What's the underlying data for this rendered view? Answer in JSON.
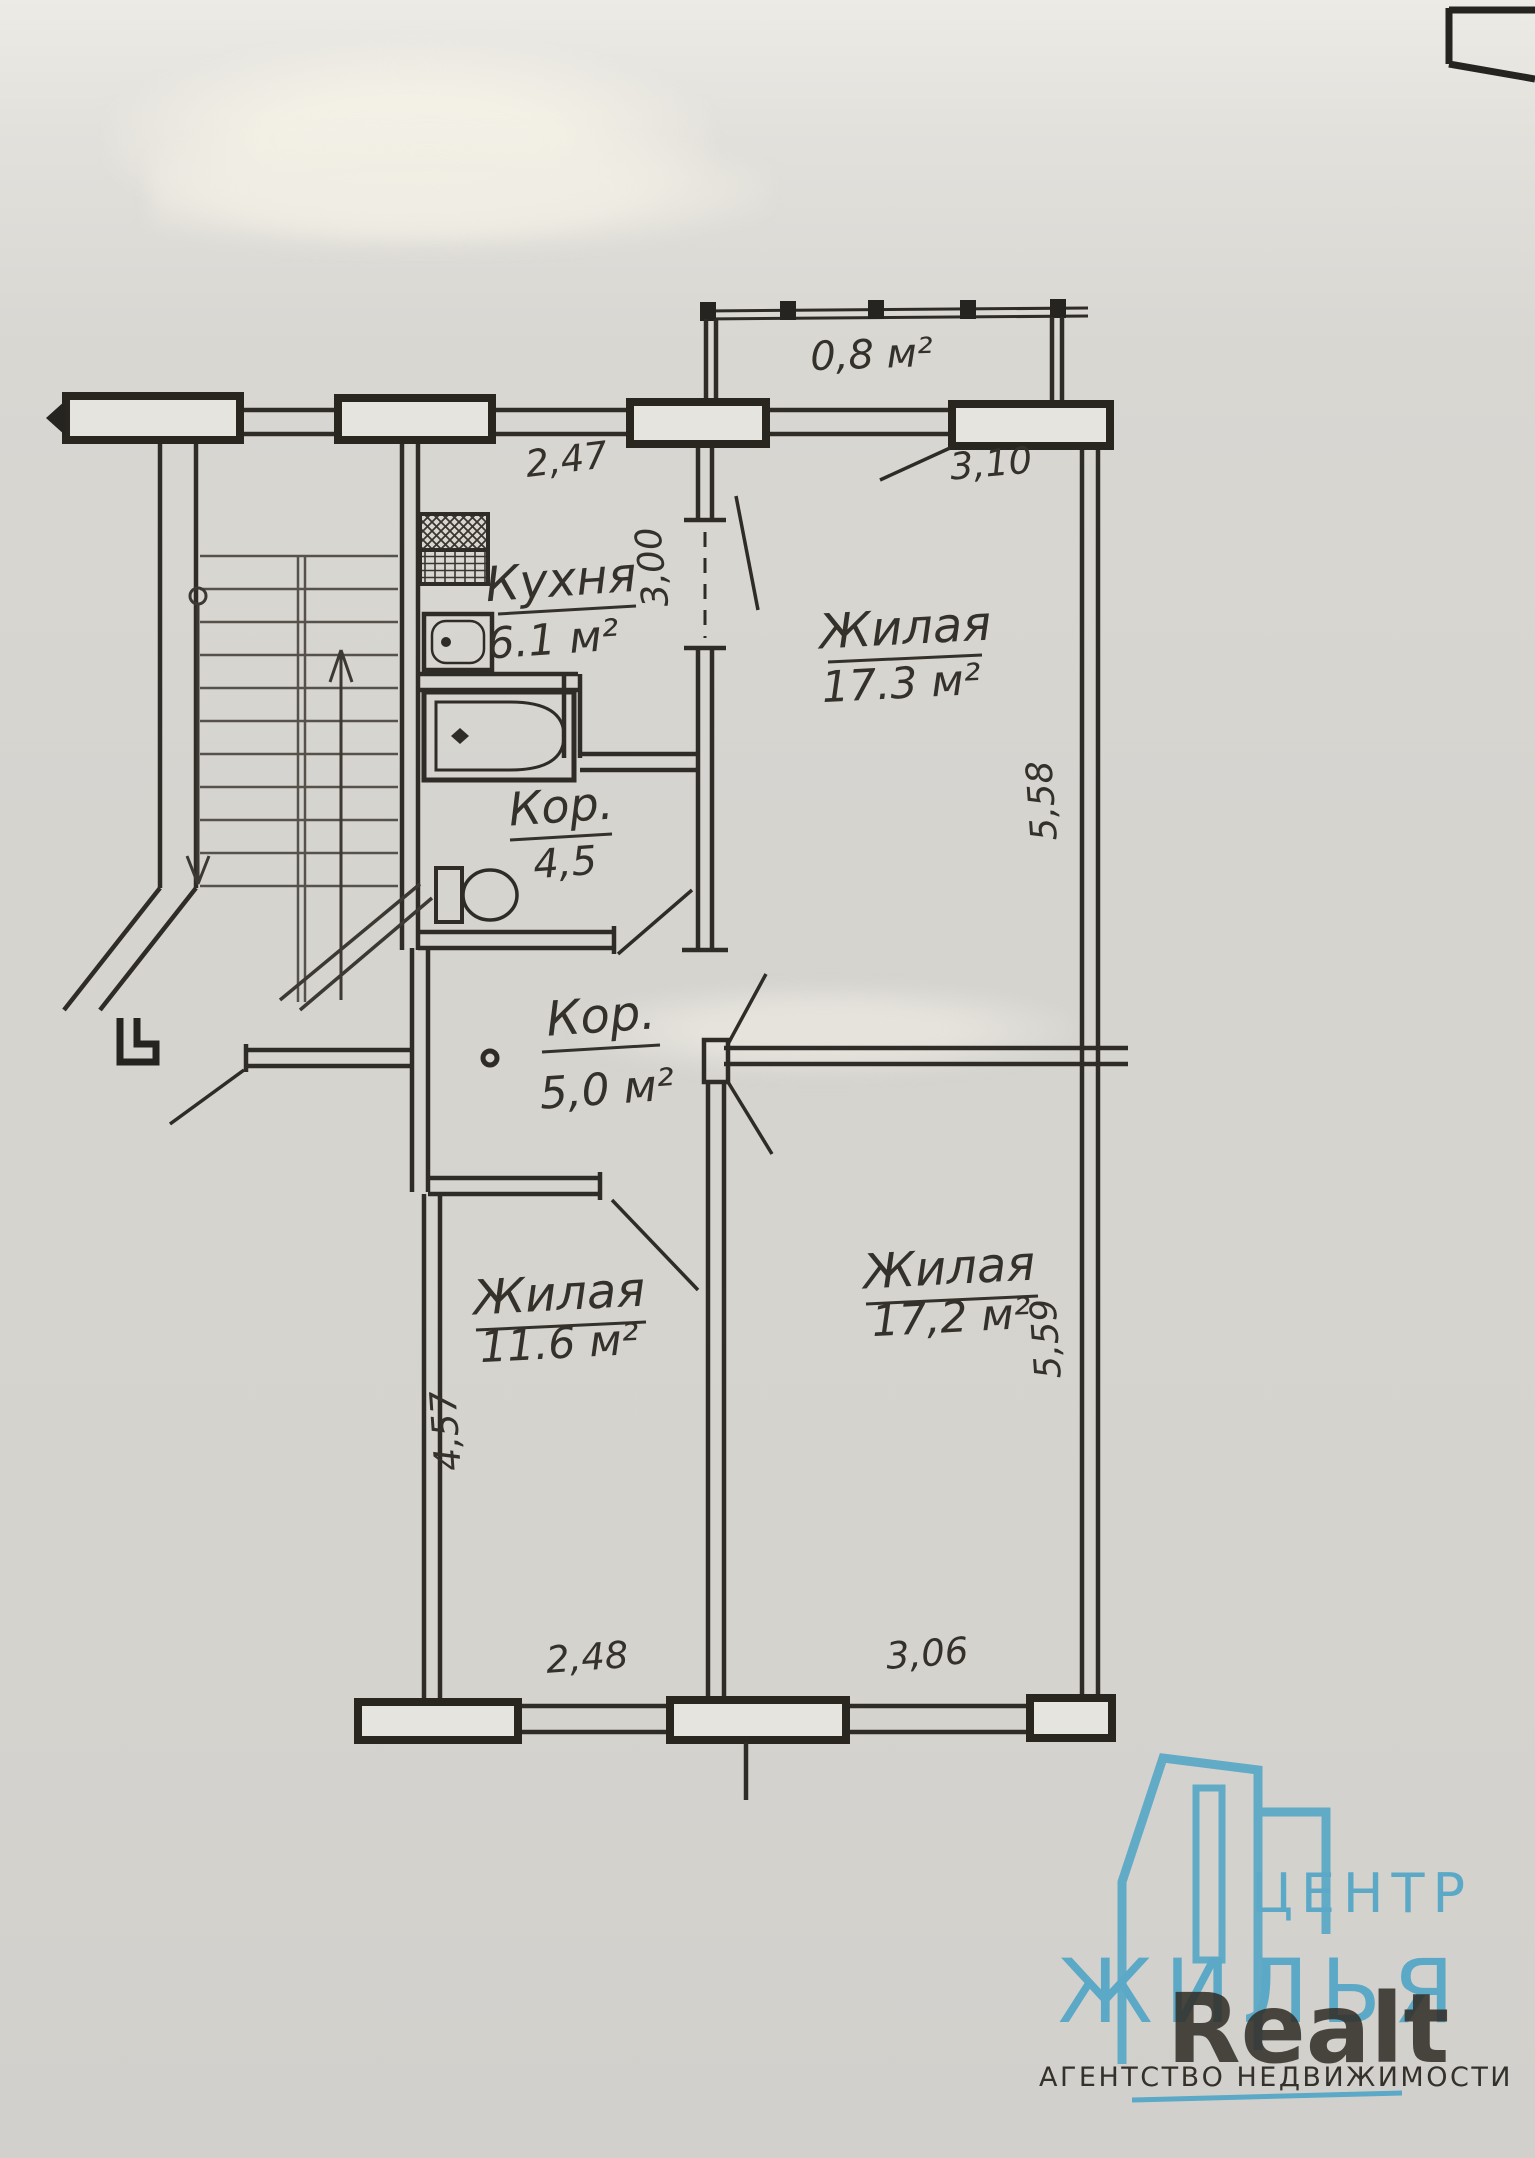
{
  "document": {
    "kind": "apartment floor plan scan",
    "colors": {
      "paper": "#d6d4cf",
      "ink": "#2f2c27",
      "accent_blue": "#5ba9c6",
      "logo_gray": "#8b8b87"
    }
  },
  "plan": {
    "balcony": {
      "area": "0,8 м²"
    },
    "kitchen": {
      "name": "Кухня",
      "area": "6.1 м²"
    },
    "room_top": {
      "name": "Жилая",
      "area": "17.3 м²"
    },
    "bath": {
      "name": "Кор.",
      "area": "4,5"
    },
    "corridor": {
      "name": "Кор.",
      "area": "5,0 м²"
    },
    "room_bottom_left": {
      "name": "Жилая",
      "area": "11.6 м²"
    },
    "room_bottom_right": {
      "name": "Жилая",
      "area": "17,2 м²"
    },
    "dimensions": {
      "top_kitchen_width": "2,47",
      "top_room_width": "3,10",
      "kitchen_depth": "3,00",
      "room_top_depth": "5,58",
      "room_bottom_left_depth": "4,57",
      "room_bottom_right_depth": "5,59",
      "bottom_left_width": "2,48",
      "bottom_right_width": "3,06"
    }
  },
  "logo": {
    "line1": "ЦЕНТР",
    "line2": "ЖИЛЬЯ",
    "brand": "Realt",
    "subtitle": "АГЕНТСТВО НЕДВИЖИМОСТИ"
  }
}
